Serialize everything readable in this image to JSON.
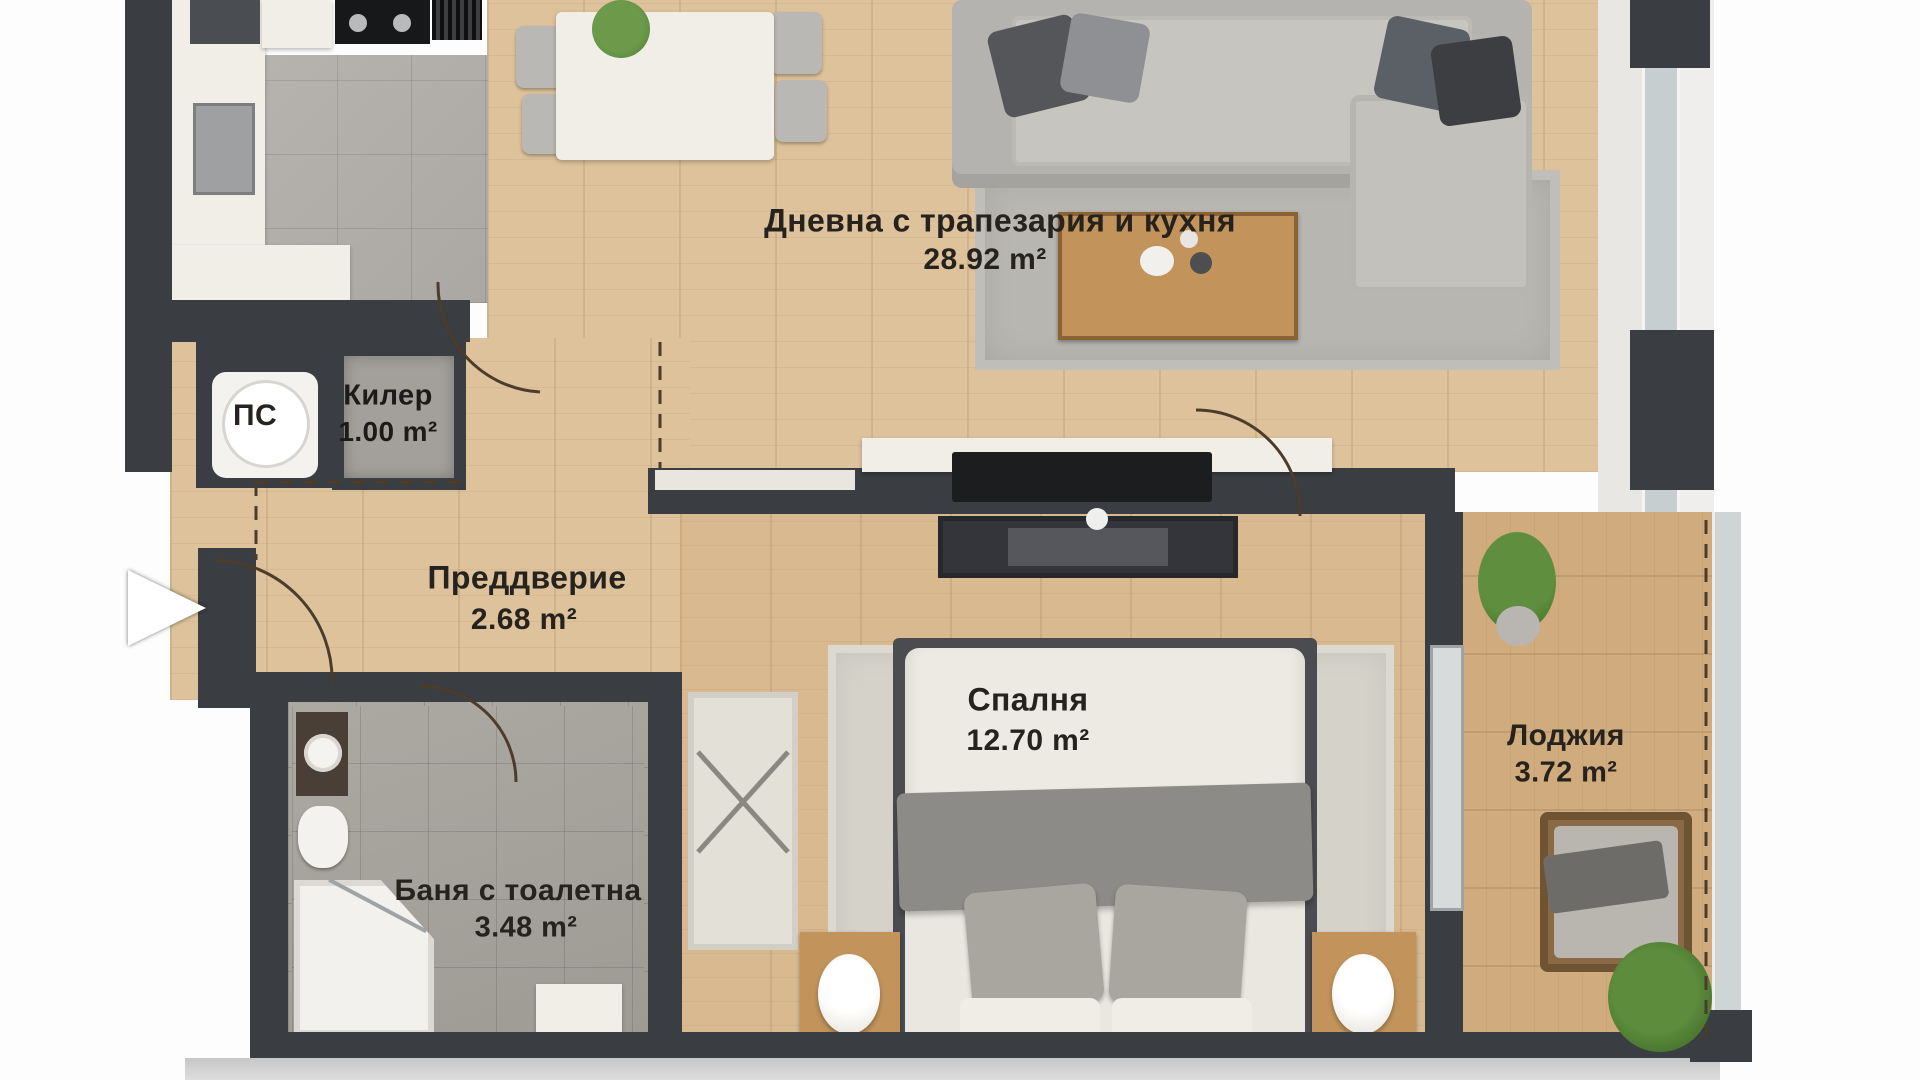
{
  "rooms": [
    {
      "id": "living",
      "name": "Дневна с трапезария и кухня",
      "area": "28.92 m²"
    },
    {
      "id": "kiler",
      "name": "Килер",
      "area": "1.00 m²"
    },
    {
      "id": "ps",
      "name": "ПС",
      "area": ""
    },
    {
      "id": "vestibule",
      "name": "Преддверие",
      "area": "2.68 m²"
    },
    {
      "id": "bedroom",
      "name": "Спалня",
      "area": "12.70 m²"
    },
    {
      "id": "loggia",
      "name": "Лоджия",
      "area": "3.72 m²"
    },
    {
      "id": "bathroom",
      "name": "Баня с тоалетна",
      "area": "3.48 m²"
    }
  ],
  "palette": {
    "wall": "#3a3d41",
    "wood_floor": "#ddc29b",
    "bedroom_wood": "#d9ba90",
    "loggia_wood": "#d0ab7d",
    "kitchen_tile": "#b0ada9",
    "bath_tile": "#a5a19b",
    "rug_gray": "#b8b6b1",
    "rug_beige": "#d5d2ca",
    "furniture_white": "#f1eee8",
    "label_text": "#26221e"
  }
}
